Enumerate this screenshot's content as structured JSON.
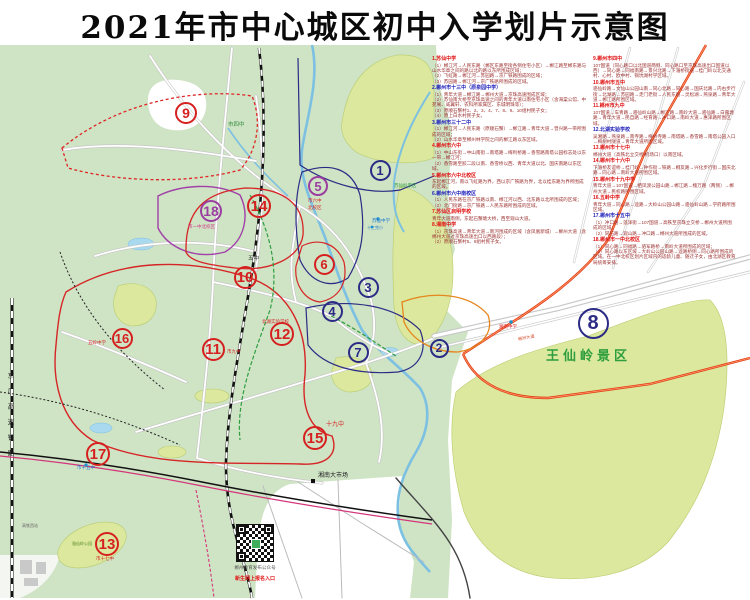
{
  "title": "2021年市中心城区初中入学划片示意图",
  "colors": {
    "land": "#cfe3c5",
    "park": "#dbe89e",
    "water": "#7cc0e2",
    "zone_red": "#d62020",
    "zone_navy": "#2b2b85",
    "zone_purple": "#9a3fa0",
    "legend_header_red": "#e01212",
    "legend_header_blue": "#1d1dbb",
    "legend_body": "#9c3030"
  },
  "railway_label": "京广高速铁路",
  "qr": {
    "caption1": "郴州教育发布公众号",
    "caption2": "新生网上报名入口"
  },
  "legend": {
    "columns": [
      {
        "entries": [
          {
            "num": "1",
            "name": "苏仙中学",
            "color": "red",
            "lines": [
              "（1）郴江河→人民东路（郴区东路至街各侧住宅小区）→郴江路至郴东路与山水华章之间的路以北的路以东所围成区域；",
              "（2）飞虹路→郴江河→苏园路→京广铁路围成的区域；",
              "（3）苏园路→郴江河→京广铁路所围成的区域。"
            ]
          },
          {
            "num": "2",
            "name": "郴州市十三中（原泉园中学）",
            "color": "blue",
            "lines": [
              "（1）青年大道→郴江路→郴州大道→京珠高速围成区域；",
              "（2）苏仙南大桥至京珠高速之间的青年大道以南住宅小区（含海棠公馆、中苑阁、威翼轩、农科所家属区、东城明珠等）；",
              "（3）原顺石蟹村1、2、3、4、7、8、9、10组村民子女；",
              "（4）原上白水村民子女。"
            ]
          },
          {
            "num": "3",
            "name": "郴州市三十二中",
            "color": "blue",
            "lines": [
              "（1）郴江河→人民东路（原顺石蟹）→郴江路→青年大道→曾兴路一带所围成的区域；",
              "（2）山水华章至郴州林学院之间的郴江路以东区域。"
            ]
          },
          {
            "num": "4",
            "name": "郴州市六中",
            "color": "red",
            "lines": [
              "（1）中山东街→中山南街→南塔路→梅利桥路→香雪路南塔公园标志处以东一带→郴江河；",
              "（2）香雪路至胶二段以南、香雪桥以西、青年大道以北、国庆南路以东区域。"
            ]
          },
          {
            "num": "5",
            "name": "郴州市六中北校区",
            "color": "red",
            "lines": [
              "东起郴江河，南以飞虹路为界，西以京广铁路为界，北以桂东路为界所围成的区域。"
            ]
          },
          {
            "num": "6",
            "name": "郴州市六中南校区",
            "color": "blue",
            "lines": [
              "（1）人民东路在京广铁路以南、郴江河以西、北东路以北所围成的区域；",
              "（2）北门街路→京广铁路→人民东路所围成的区域。"
            ]
          },
          {
            "num": "7",
            "name": "苏仙区启明学校",
            "color": "red",
            "lines": [
              "青年大道南侧，东起石蟹塘大桥，西至观山大道。"
            ]
          },
          {
            "num": "8",
            "name": "湘南中学",
            "color": "red",
            "lines": [
              "（1）京珠高速→青年大道→南河围成的区域（含凤凰新城）→郴州大道（含郴州大道过京珠高速出口以西路段）；",
              "（2）原顺石蟹村5、6组村民子女。"
            ]
          }
        ]
      },
      {
        "entries": [
          {
            "num": "9",
            "name": "郴州市四中",
            "color": "red",
            "lines": [
              "107国道（同心路口以北国道两侧、同心路口至京珠高速出口国道以西）→同心路→同福南路→景兴北路→下湄桥街道→桂门岭以北交通村、心村、欧中村、铜坑湖村学区域。"
            ]
          },
          {
            "num": "10",
            "name": "郴州市五中",
            "color": "red",
            "lines": [
              "骆仙岭路→文仙山公园山南→同心北路→同心路→国庆北路→内右步行街→北湖路→苏园路→走门老街→人民东路→灵松湖→燕泉路→青年大道→郴江路所围区域。"
            ]
          },
          {
            "num": "11",
            "name": "郴州市九中",
            "color": "red",
            "lines": [
              "107国道→车青路→骆仙岭山路→郴江路→南岭大道→骆仙路→白露塘路→青年大道→民自路→经育路→冲口路→南岭大道→惠泽路所围区域。"
            ]
          },
          {
            "num": "12",
            "name": "北湖实验学校",
            "color": "blue",
            "lines": [
              "吴湘路→燕泉路→南寺路→梅桥寺路→南塔路→香雪路→南塔公园入口→梅树村隧道→青年大道所围区域。"
            ]
          },
          {
            "num": "13",
            "name": "郴州市十七中",
            "color": "red",
            "lines": [
              "郴州大道（高铁北立交桥/机场口）以南区域。"
            ]
          },
          {
            "num": "14",
            "name": "郴州市十六中",
            "color": "red",
            "lines": [
              "下湄桥友谊桥→桂门岭→钟作街→铁路→桐友路→兴化步行街→国庆北路→同心路→南岭大道所围区域。"
            ]
          },
          {
            "num": "15",
            "name": "郴州市十九中学",
            "color": "red",
            "lines": [
              "青年大道→107国道→栖凤渡公园山路→郴江路→槐万路（两侧）→郴州大道→民权路所围区域。"
            ]
          },
          {
            "num": "16",
            "name": "五岭中学",
            "color": "red",
            "lines": [
              "青年大道→同心路→逵路→大岭山公园山路→骆仙岭山路→学府路所围区域。"
            ]
          },
          {
            "num": "17",
            "name": "郴州市十五中",
            "color": "blue",
            "lines": [
              "（1）冲口路→莲泽街→107国道→高铁至京珠立交桥→郴州大道所围成的区域；",
              "（2）同石路→观山路→冲口路→郴州大道所围成的区域。"
            ]
          },
          {
            "num": "18",
            "name": "郴州市一中北校区",
            "color": "red",
            "lines": [
              "（1）同心路→同福路→骆军路桥→南岭大道所围成的区域；",
              "（2）同心路以东区域→大岭山公园山路→逵路桥侧→同心路所围成的区域。在一中北校区划片区域内的适龄儿童、随迁子女，由北湖区教育局统筹安排。"
            ]
          }
        ]
      }
    ]
  },
  "zones": [
    {
      "n": "1",
      "x": 380,
      "y": 170,
      "c": "navy",
      "s": 21
    },
    {
      "n": "2",
      "x": 439,
      "y": 348,
      "c": "navy",
      "s": 19
    },
    {
      "n": "3",
      "x": 368,
      "y": 287,
      "c": "navy",
      "s": 21
    },
    {
      "n": "4",
      "x": 332,
      "y": 311,
      "c": "navy",
      "s": 21
    },
    {
      "n": "5",
      "x": 318,
      "y": 186,
      "c": "purple",
      "s": 20
    },
    {
      "n": "6",
      "x": 324,
      "y": 264,
      "c": "red",
      "s": 21
    },
    {
      "n": "7",
      "x": 358,
      "y": 352,
      "c": "navy",
      "s": 21
    },
    {
      "n": "8",
      "x": 593,
      "y": 323,
      "c": "navy",
      "s": 31
    },
    {
      "n": "9",
      "x": 186,
      "y": 113,
      "c": "red",
      "s": 22
    },
    {
      "n": "10",
      "x": 245,
      "y": 277,
      "c": "red",
      "s": 23
    },
    {
      "n": "11",
      "x": 213,
      "y": 349,
      "c": "red",
      "s": 23
    },
    {
      "n": "12",
      "x": 282,
      "y": 334,
      "c": "red",
      "s": 24
    },
    {
      "n": "13",
      "x": 107,
      "y": 544,
      "c": "red",
      "s": 24
    },
    {
      "n": "14",
      "x": 259,
      "y": 206,
      "c": "red",
      "s": 24
    },
    {
      "n": "15",
      "x": 315,
      "y": 438,
      "c": "red",
      "s": 24
    },
    {
      "n": "16",
      "x": 122,
      "y": 338,
      "c": "red",
      "s": 21
    },
    {
      "n": "17",
      "x": 98,
      "y": 454,
      "c": "red",
      "s": 24
    },
    {
      "n": "18",
      "x": 211,
      "y": 211,
      "c": "purple",
      "s": 22
    }
  ],
  "labels": [
    {
      "t": "市四中",
      "x": 228,
      "y": 123,
      "c": "#2e8b3a",
      "fs": 5.5
    },
    {
      "t": "市一中北校区",
      "x": 188,
      "y": 225,
      "c": "#d43a8a",
      "fs": 4.5
    },
    {
      "t": "市六中",
      "x": 308,
      "y": 199,
      "c": "#d62525",
      "fs": 4.5
    },
    {
      "t": "北校区",
      "x": 308,
      "y": 206,
      "c": "#d62525",
      "fs": 4.5
    },
    {
      "t": "五中",
      "x": 248,
      "y": 257,
      "c": "#333333",
      "fs": 5.5
    },
    {
      "t": "苏仙岭景区",
      "x": 394,
      "y": 184,
      "c": "#2e9e3e",
      "fs": 4.5
    },
    {
      "t": "苏仙中学",
      "x": 372,
      "y": 219,
      "c": "#1e7ad0",
      "fs": 4.5
    },
    {
      "t": "十三完小",
      "x": 367,
      "y": 226,
      "c": "#1e7ad0",
      "fs": 4
    },
    {
      "t": "北湖实验学校",
      "x": 262,
      "y": 320,
      "c": "#d62525",
      "fs": 4.5
    },
    {
      "t": "市九中",
      "x": 227,
      "y": 350,
      "c": "#d62525",
      "fs": 4.5
    },
    {
      "t": "十九中",
      "x": 326,
      "y": 422,
      "c": "#d62525",
      "fs": 6
    },
    {
      "t": "湘南大市场",
      "x": 318,
      "y": 473,
      "c": "#1a1a1a",
      "fs": 6
    },
    {
      "t": "王仙岭景区",
      "x": 546,
      "y": 349,
      "c": "#2e9e3e",
      "fs": 13,
      "b": 1,
      "ls": 4
    },
    {
      "t": "湘南中学",
      "x": 499,
      "y": 325,
      "c": "#d62525",
      "fs": 4.5
    },
    {
      "t": "市十五中",
      "x": 77,
      "y": 466,
      "c": "#1e7ad0",
      "fs": 4.5
    },
    {
      "t": "市十七中",
      "x": 96,
      "y": 557,
      "c": "#d62525",
      "fs": 4.5
    },
    {
      "t": "五岭中学",
      "x": 88,
      "y": 341,
      "c": "#d62525",
      "fs": 4.5
    },
    {
      "t": "郴州大道",
      "x": 518,
      "y": 336,
      "c": "#d64a2a",
      "fs": 4.2,
      "r": -11
    },
    {
      "t": "骆仙岭公园",
      "x": 72,
      "y": 542,
      "c": "#5a8a2a",
      "fs": 4
    },
    {
      "t": "高铁西站",
      "x": 22,
      "y": 524,
      "c": "#666666",
      "fs": 4
    }
  ]
}
